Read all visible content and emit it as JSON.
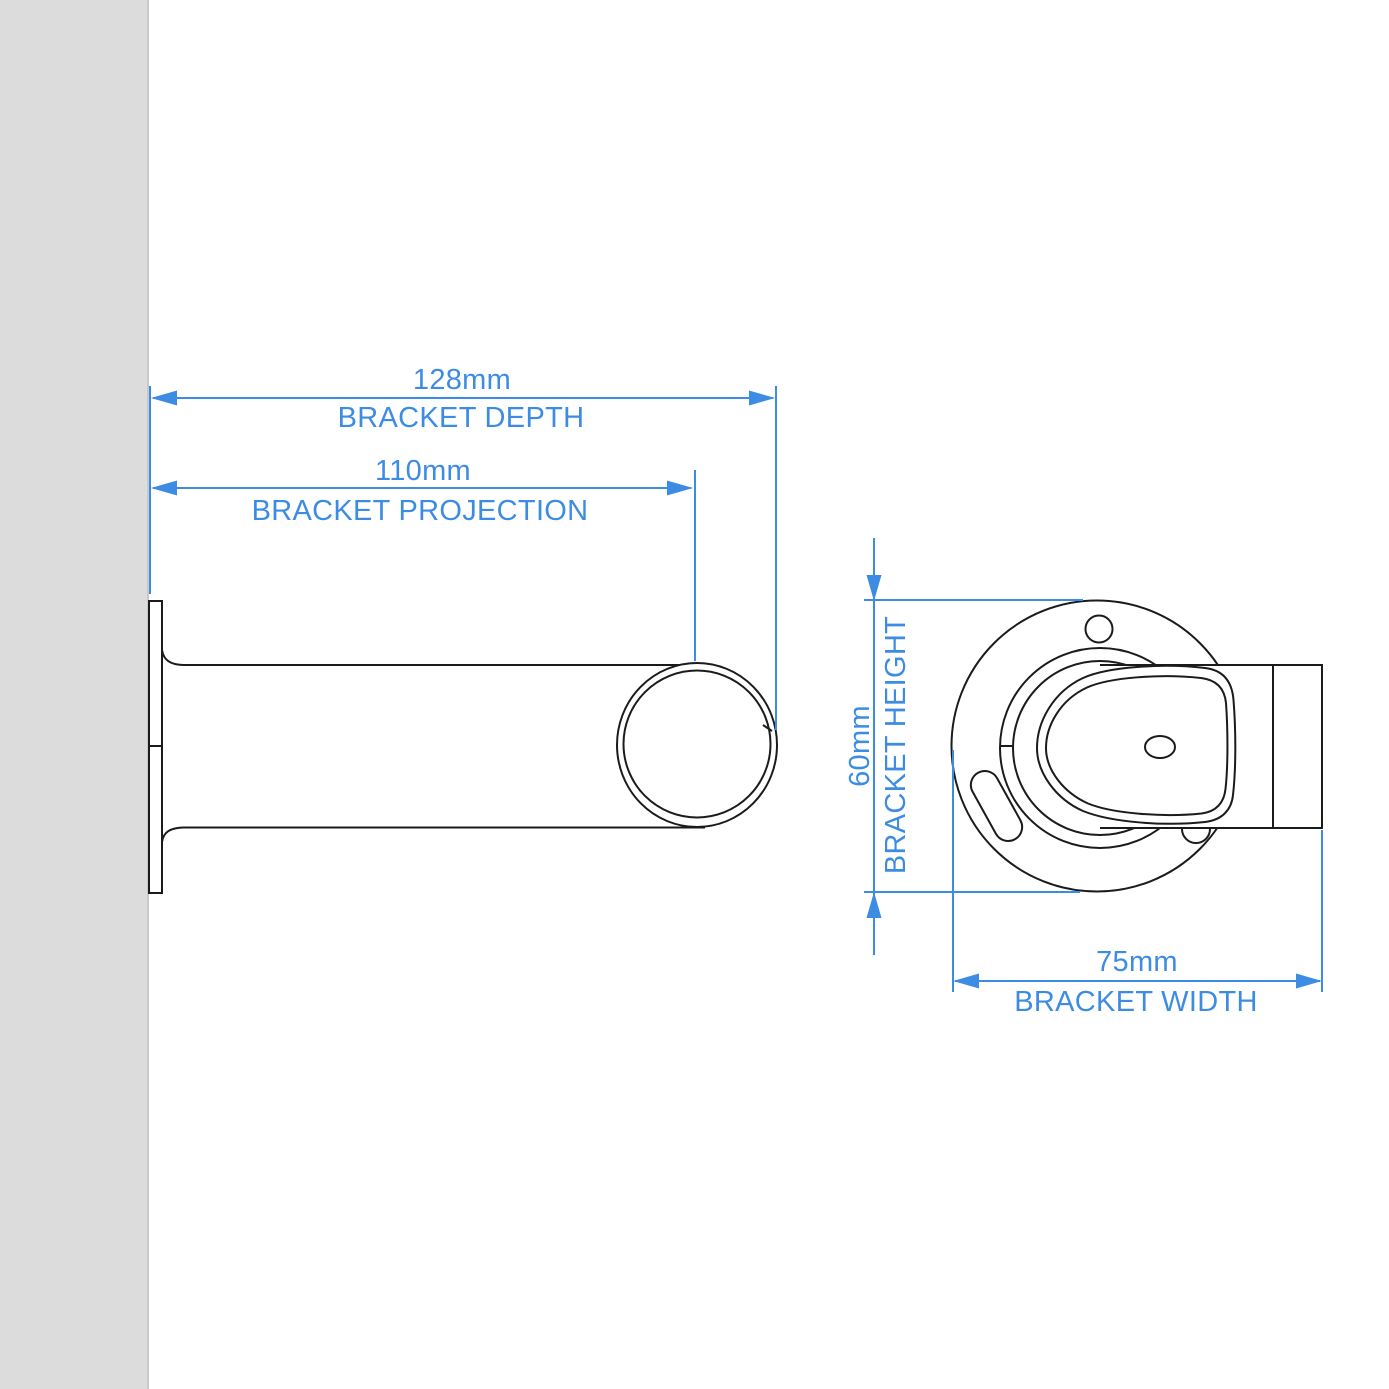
{
  "diagram": {
    "type": "technical-drawing",
    "views": {
      "side_view": "bracket side profile (wall plate, stem, pole cup)",
      "front_view": "bracket front face (round wall plate with screw holes and pole cup)"
    },
    "colors": {
      "dimension_blue": "#3d8ce4",
      "outline_black": "#1b1b1b",
      "wall_gray": "#dcdcdc",
      "wall_edge_gray": "#c9c9c9",
      "background": "#ffffff"
    },
    "dimensions": {
      "depth": {
        "value": "128mm",
        "label": "BRACKET DEPTH"
      },
      "projection": {
        "value": "110mm",
        "label": "BRACKET PROJECTION"
      },
      "height": {
        "value": "60mm",
        "label": "BRACKET HEIGHT"
      },
      "width": {
        "value": "75mm",
        "label": "BRACKET WIDTH"
      }
    }
  }
}
